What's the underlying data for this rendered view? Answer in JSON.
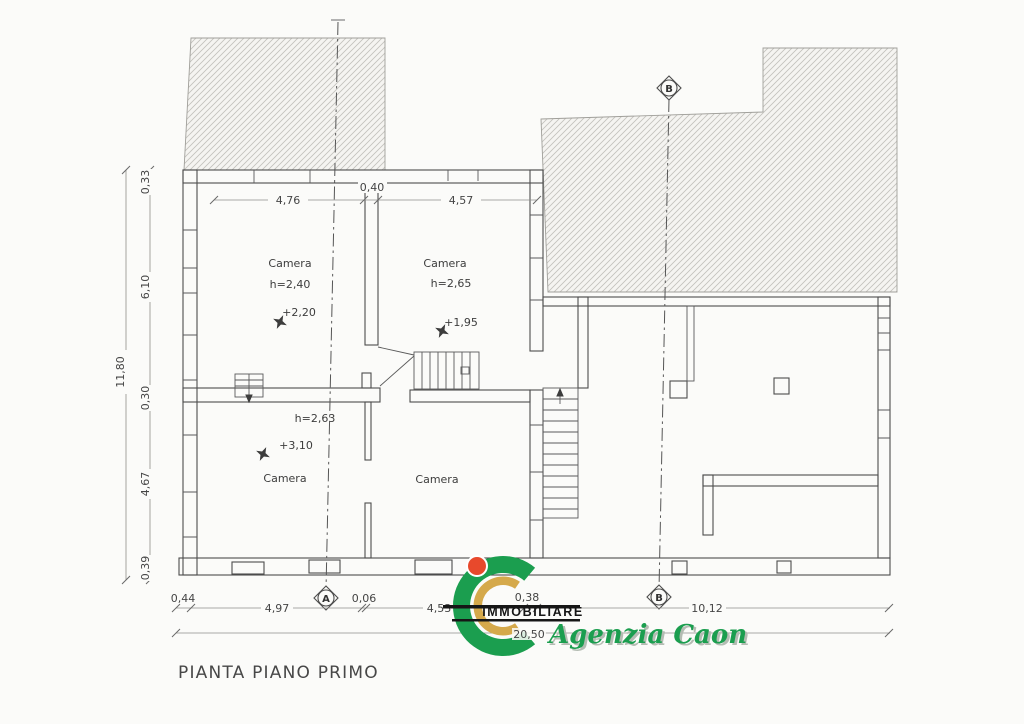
{
  "title": "PIANTA PIANO PRIMO",
  "rooms": {
    "upper_left": {
      "name": "Camera",
      "height": "h=2,40",
      "level": "+2,20"
    },
    "upper_right": {
      "name": "Camera",
      "height": "h=2,65",
      "level": "+1,95"
    },
    "lower_left": {
      "name": "Camera",
      "height": "h=2,63",
      "level": "+3,10"
    },
    "lower_right": {
      "name": "Camera"
    }
  },
  "dimensions": {
    "top": [
      "4,76",
      "0,40",
      "4,57"
    ],
    "left": {
      "total": "11,80",
      "segments": [
        "0,33",
        "6,10",
        "0,30",
        "4,67",
        "0,39"
      ]
    },
    "bottom": {
      "segments": [
        "0,44",
        "4,97",
        "0,06",
        "4,53",
        "0,38",
        "10,12"
      ],
      "total": "20,50"
    }
  },
  "axes": {
    "a": "A",
    "b": "B"
  },
  "logo": {
    "brand": "IMMOBILIARE",
    "agency": "Agenzia Caon"
  },
  "colors": {
    "wall_line": "#4d4d4d",
    "dim_line": "#8f8e8a",
    "hatch_line": "#c2c1bc",
    "hatch_bg": "#f5f4f1",
    "logo_green": "#1b9e4f",
    "logo_gold": "#d5a94b",
    "logo_red": "#e8492c",
    "logo_black": "#161616",
    "agency_shadow": "#b4bcb3"
  }
}
